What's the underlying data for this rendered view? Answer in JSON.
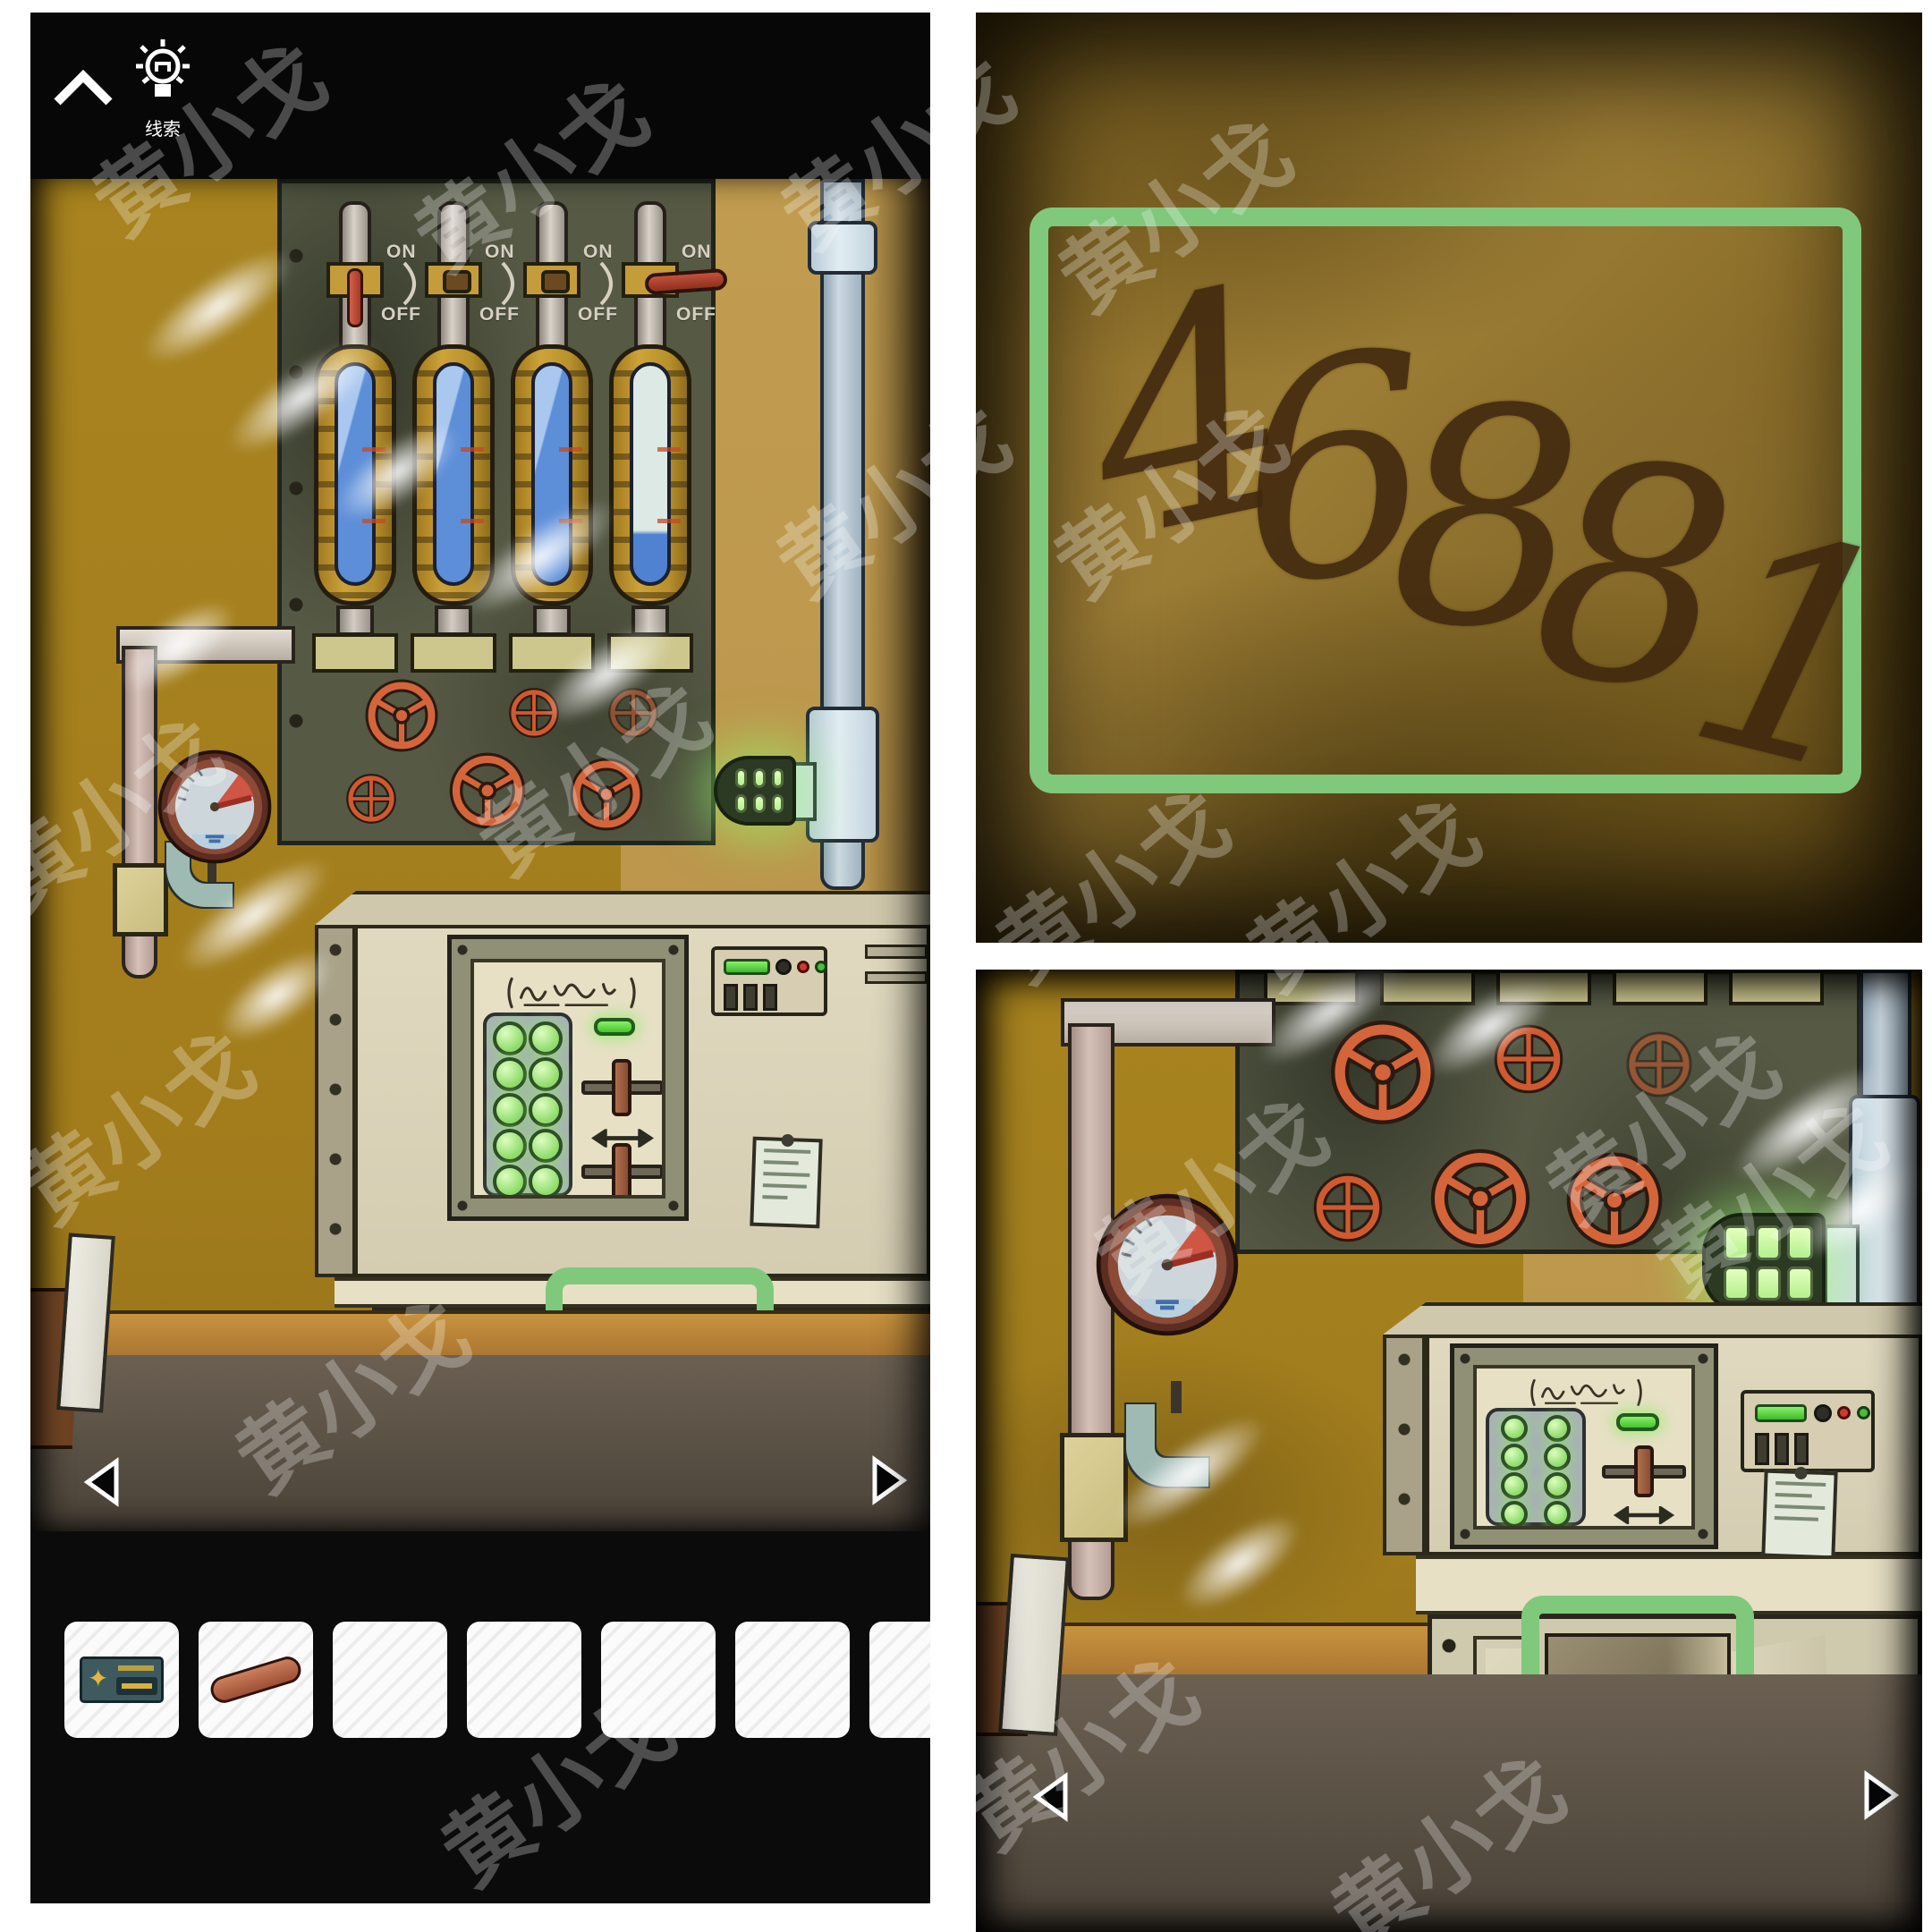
{
  "watermark": {
    "text": "黄小戈",
    "positions": [
      [
        230,
        150
      ],
      [
        590,
        190
      ],
      [
        115,
        905
      ],
      [
        660,
        865
      ],
      [
        150,
        1255
      ],
      [
        390,
        1555
      ],
      [
        620,
        1995
      ],
      [
        1000,
        165
      ],
      [
        1310,
        235
      ],
      [
        995,
        555
      ],
      [
        1305,
        555
      ],
      [
        1240,
        985
      ],
      [
        1520,
        995
      ],
      [
        1350,
        1330
      ],
      [
        1855,
        1255
      ],
      [
        1205,
        1955
      ],
      [
        1615,
        2065
      ],
      [
        1975,
        1335
      ]
    ]
  },
  "colors": {
    "highlight_green": "#7fc87c",
    "wall_mustard": "#a8831f",
    "equipment_panel": "#565a45",
    "valve_orange": "#d4653a",
    "liquid_blue": "#5d8ed8",
    "lamp_green": "#b9f59b"
  },
  "left_panel": {
    "toolbar": {
      "hint_label": "线索"
    },
    "switch_labels": {
      "on": "ON",
      "off": "OFF"
    },
    "tubes": [
      {
        "index": 1,
        "liquid": "full-blue",
        "lever": "red-rod-down"
      },
      {
        "index": 2,
        "liquid": "full-blue",
        "lever": "knob"
      },
      {
        "index": 3,
        "liquid": "full-blue",
        "lever": "knob"
      },
      {
        "index": 4,
        "liquid": "low",
        "lever": "red-handle-horizontal"
      }
    ],
    "valve_wheels": {
      "row1": [
        "three-spoke",
        "cross",
        "cross-faint"
      ],
      "row2": [
        "cross",
        "three-spoke",
        "three-spoke"
      ]
    },
    "highlight": "closed cabinet right door",
    "inventory": {
      "slot_count": 7,
      "items": [
        {
          "slot": 1,
          "name": "metal-plate-with-star"
        },
        {
          "slot": 2,
          "name": "red-valve-lever"
        }
      ]
    }
  },
  "top_right_panel": {
    "code": {
      "value": "46881",
      "digits": [
        "4",
        "6",
        "8",
        "8",
        "1"
      ]
    }
  },
  "bottom_right_panel": {
    "highlight": "open cabinet with scissors",
    "cabinet_item": "scissors"
  }
}
